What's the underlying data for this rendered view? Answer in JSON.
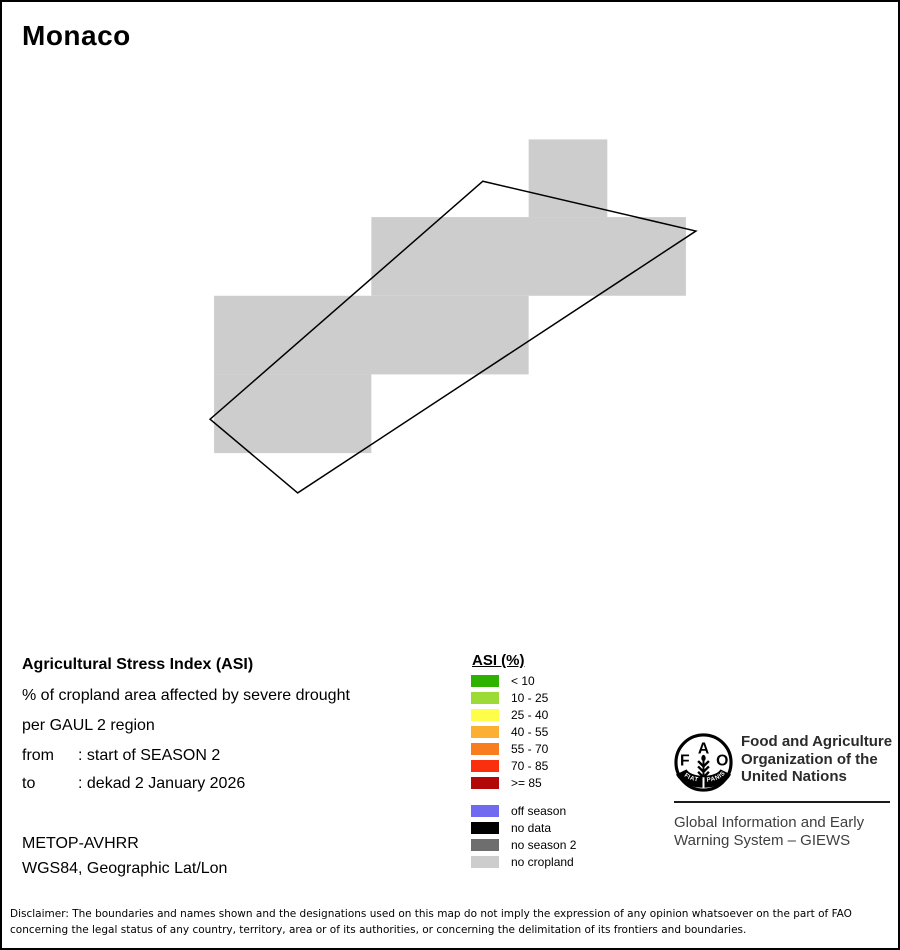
{
  "page": {
    "title": "Monaco",
    "background": "#ffffff",
    "border_color": "#000000"
  },
  "map": {
    "no_cropland_color": "#cdcdcd",
    "boundary_color": "#000000",
    "cells": [
      {
        "x": 529,
        "y": 138,
        "w": 79,
        "h": 78
      },
      {
        "x": 371,
        "y": 216,
        "w": 316,
        "h": 79
      },
      {
        "x": 213,
        "y": 295,
        "w": 316,
        "h": 79
      },
      {
        "x": 213,
        "y": 374,
        "w": 158,
        "h": 79
      }
    ],
    "boundary_points": "483,180 697,230 297,493 209,419"
  },
  "info_block": {
    "heading": "Agricultural Stress Index (ASI)",
    "subtitle1": "% of cropland area affected by severe drought",
    "subtitle2": "per GAUL 2 region",
    "from_label": "from",
    "from_value": ": start of SEASON 2",
    "to_label": "to",
    "to_value": ": dekad 2 January 2026",
    "sensor": "METOP-AVHRR",
    "projection": "WGS84, Geographic Lat/Lon"
  },
  "legend": {
    "title": "ASI (%)",
    "classes": [
      {
        "label": "< 10",
        "color": "#2db200"
      },
      {
        "label": "10 - 25",
        "color": "#9cdb35"
      },
      {
        "label": "25 - 40",
        "color": "#fdfd4a"
      },
      {
        "label": "40 - 55",
        "color": "#fbb034"
      },
      {
        "label": "55 - 70",
        "color": "#f97d1e"
      },
      {
        "label": "70 - 85",
        "color": "#fa2f0e"
      },
      {
        "label": ">= 85",
        "color": "#b30808"
      }
    ],
    "categories": [
      {
        "label": "off season",
        "color": "#6f6af0"
      },
      {
        "label": "no data",
        "color": "#000000"
      },
      {
        "label": "no season 2",
        "color": "#6e6e6e"
      },
      {
        "label": "no cropland",
        "color": "#cdcdcd"
      }
    ]
  },
  "fao": {
    "org_line1": "Food and Agriculture",
    "org_line2": "Organization of the",
    "org_line3": "United Nations",
    "giews_line1": "Global Information and Early",
    "giews_line2": "Warning System – GIEWS",
    "logo": {
      "f": "F",
      "a": "A",
      "o": "O",
      "fiat": "FIAT",
      "panis": "PANIS"
    }
  },
  "disclaimer": {
    "line1": "Disclaimer: The boundaries and names shown and the designations used on this map do not imply the expression of any opinion whatsoever on the part of FAO",
    "line2": "concerning the legal status of any country, territory, area or of its authorities, or concerning the delimitation of its frontiers and boundaries."
  }
}
